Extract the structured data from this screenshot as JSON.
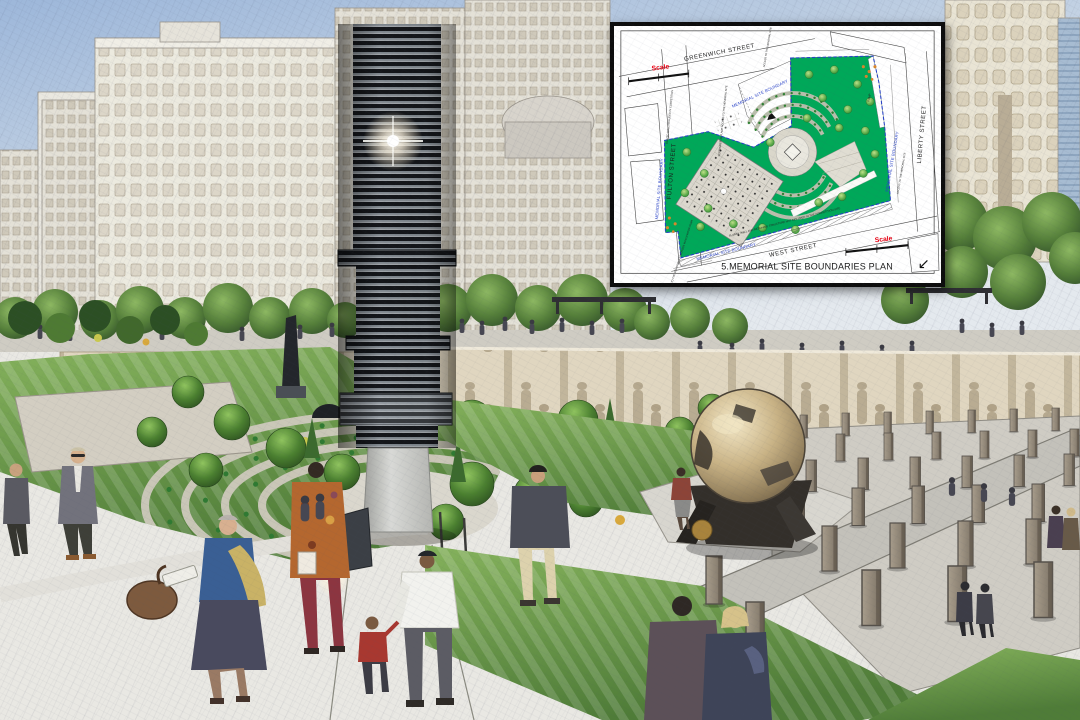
{
  "inset_plan": {
    "title": "5.MEMORIAL SITE BOUNDARIES PLAN",
    "scale_label": "Scale",
    "streets": {
      "top": "GREENWICH STREET",
      "left": "FULTON STREET",
      "right": "LIBERTY STREET",
      "bottom": "WEST STREET"
    },
    "boundary_label": "MEMORIAL SITE BOUNDARY",
    "notes": {
      "slurry_wall": "SLURRY WALL AND RETAINING STRUCTURE NOT INCLUDED IN THE COMPETITION SITE",
      "september_place": "SEPTEMBER 11 PLACE ACCESS TO THE MEMORIAL SITE",
      "glazed_wall": "GLAZED WALL INCLUDED IN COMPETITION",
      "access_bedrock": "ACCESS TO THE MEMORIAL AT BEDROCK VIA ELEVATOR STAIR",
      "access_site": "ACCESS TO THE MEMORIAL SITE",
      "ramp": "RAMP"
    },
    "icons": {
      "north_arrow": "↙"
    },
    "colors": {
      "park_green": "#00a859",
      "boundary_blue": "#2741c8",
      "scale_red": "#e60012",
      "ink": "#1a1a1a"
    }
  }
}
